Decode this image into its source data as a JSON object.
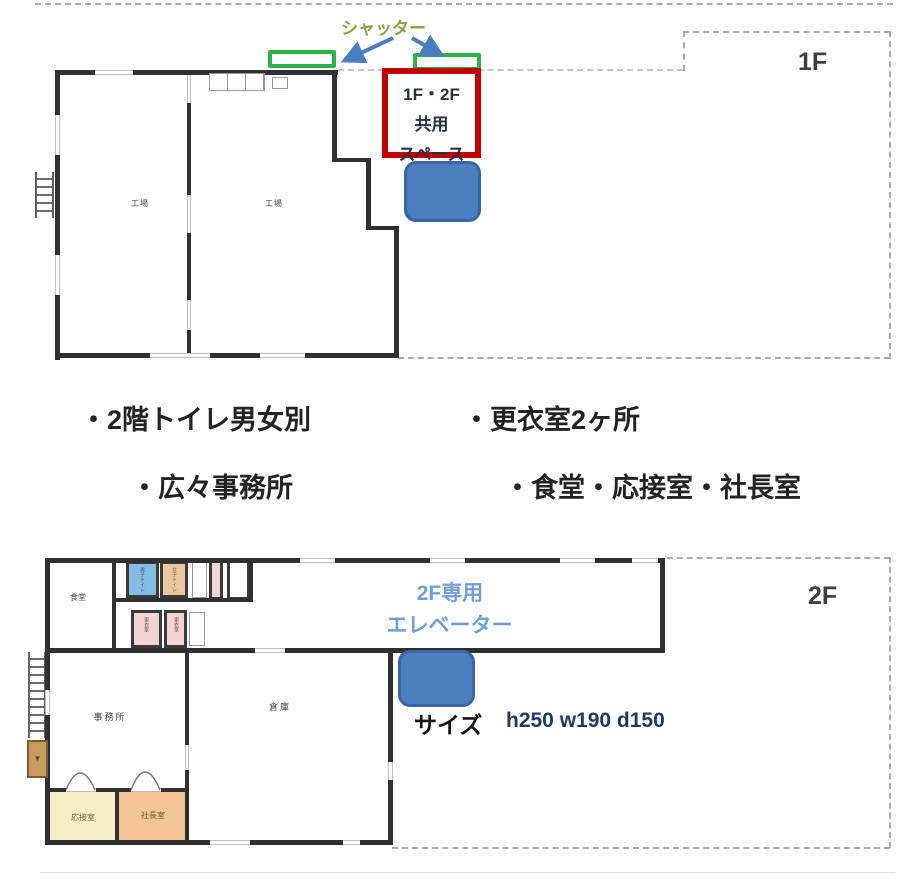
{
  "colors": {
    "shutter_green": "#2db34a",
    "highlight_red": "#c00000",
    "elevator_blue": "#4d7ebf",
    "arrow_blue": "#4a7ec0",
    "shutter_caption_olive": "#8aa23c",
    "elevator_caption_blue": "#6f9fd8",
    "size_value_navy": "#1f3864"
  },
  "floor1": {
    "label": "1F",
    "shutter_label": "シャッター",
    "shared_space": {
      "line1": "1F・2F",
      "line2": "共用",
      "line3": "スペース"
    },
    "rooms": {
      "left": "工場",
      "right": "工場"
    }
  },
  "features": {
    "item1": "・2階トイレ男女別",
    "item2": "・更衣室2ヶ所",
    "item3": "・広々事務所",
    "item4": "・食堂・応接室・社長室"
  },
  "floor2": {
    "label": "2F",
    "elevator_caption": {
      "line1": "2F専用",
      "line2": "エレベーター"
    },
    "size": {
      "label": "サイズ",
      "value": "h250 w190 d150"
    },
    "rooms": {
      "dining": "食堂",
      "toilet_men": "男子トイレ",
      "toilet_women": "女子トイレ",
      "locker1": "更衣室",
      "locker2": "更衣室",
      "office": "事務所",
      "storage": "倉庫",
      "reception": "応接室",
      "president": "社長室"
    }
  }
}
